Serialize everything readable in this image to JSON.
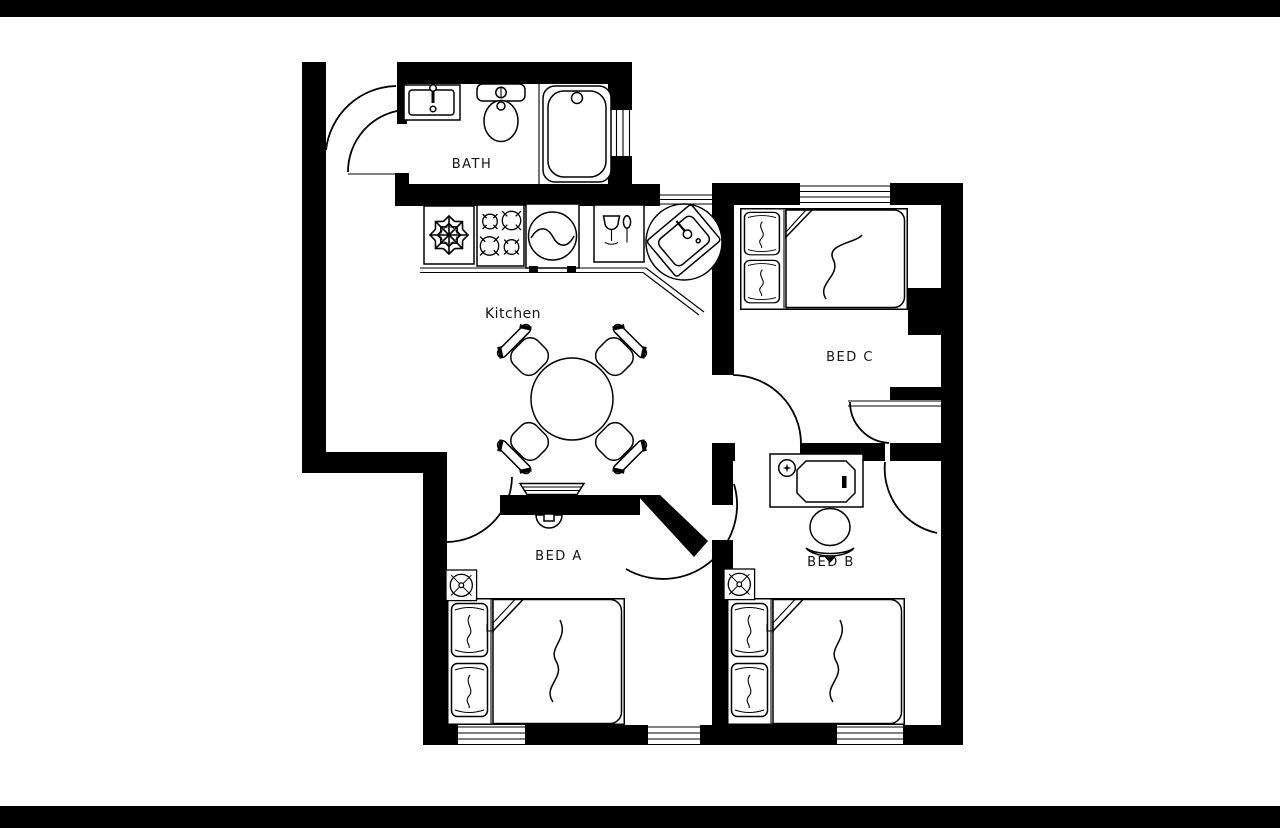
{
  "canvas": {
    "width": 1280,
    "height": 828,
    "background": "#ffffff",
    "letterbox_color": "#000000"
  },
  "style": {
    "wall_color": "#000000",
    "line_color": "#000000",
    "floor_color": "#ffffff",
    "label_color": "#141414"
  },
  "rooms": {
    "bath": {
      "label": "BATH"
    },
    "kitchen": {
      "label": "Kitchen"
    },
    "bed_a": {
      "label": "BED A"
    },
    "bed_b": {
      "label": "BED B"
    },
    "bed_c": {
      "label": "BED C"
    }
  }
}
